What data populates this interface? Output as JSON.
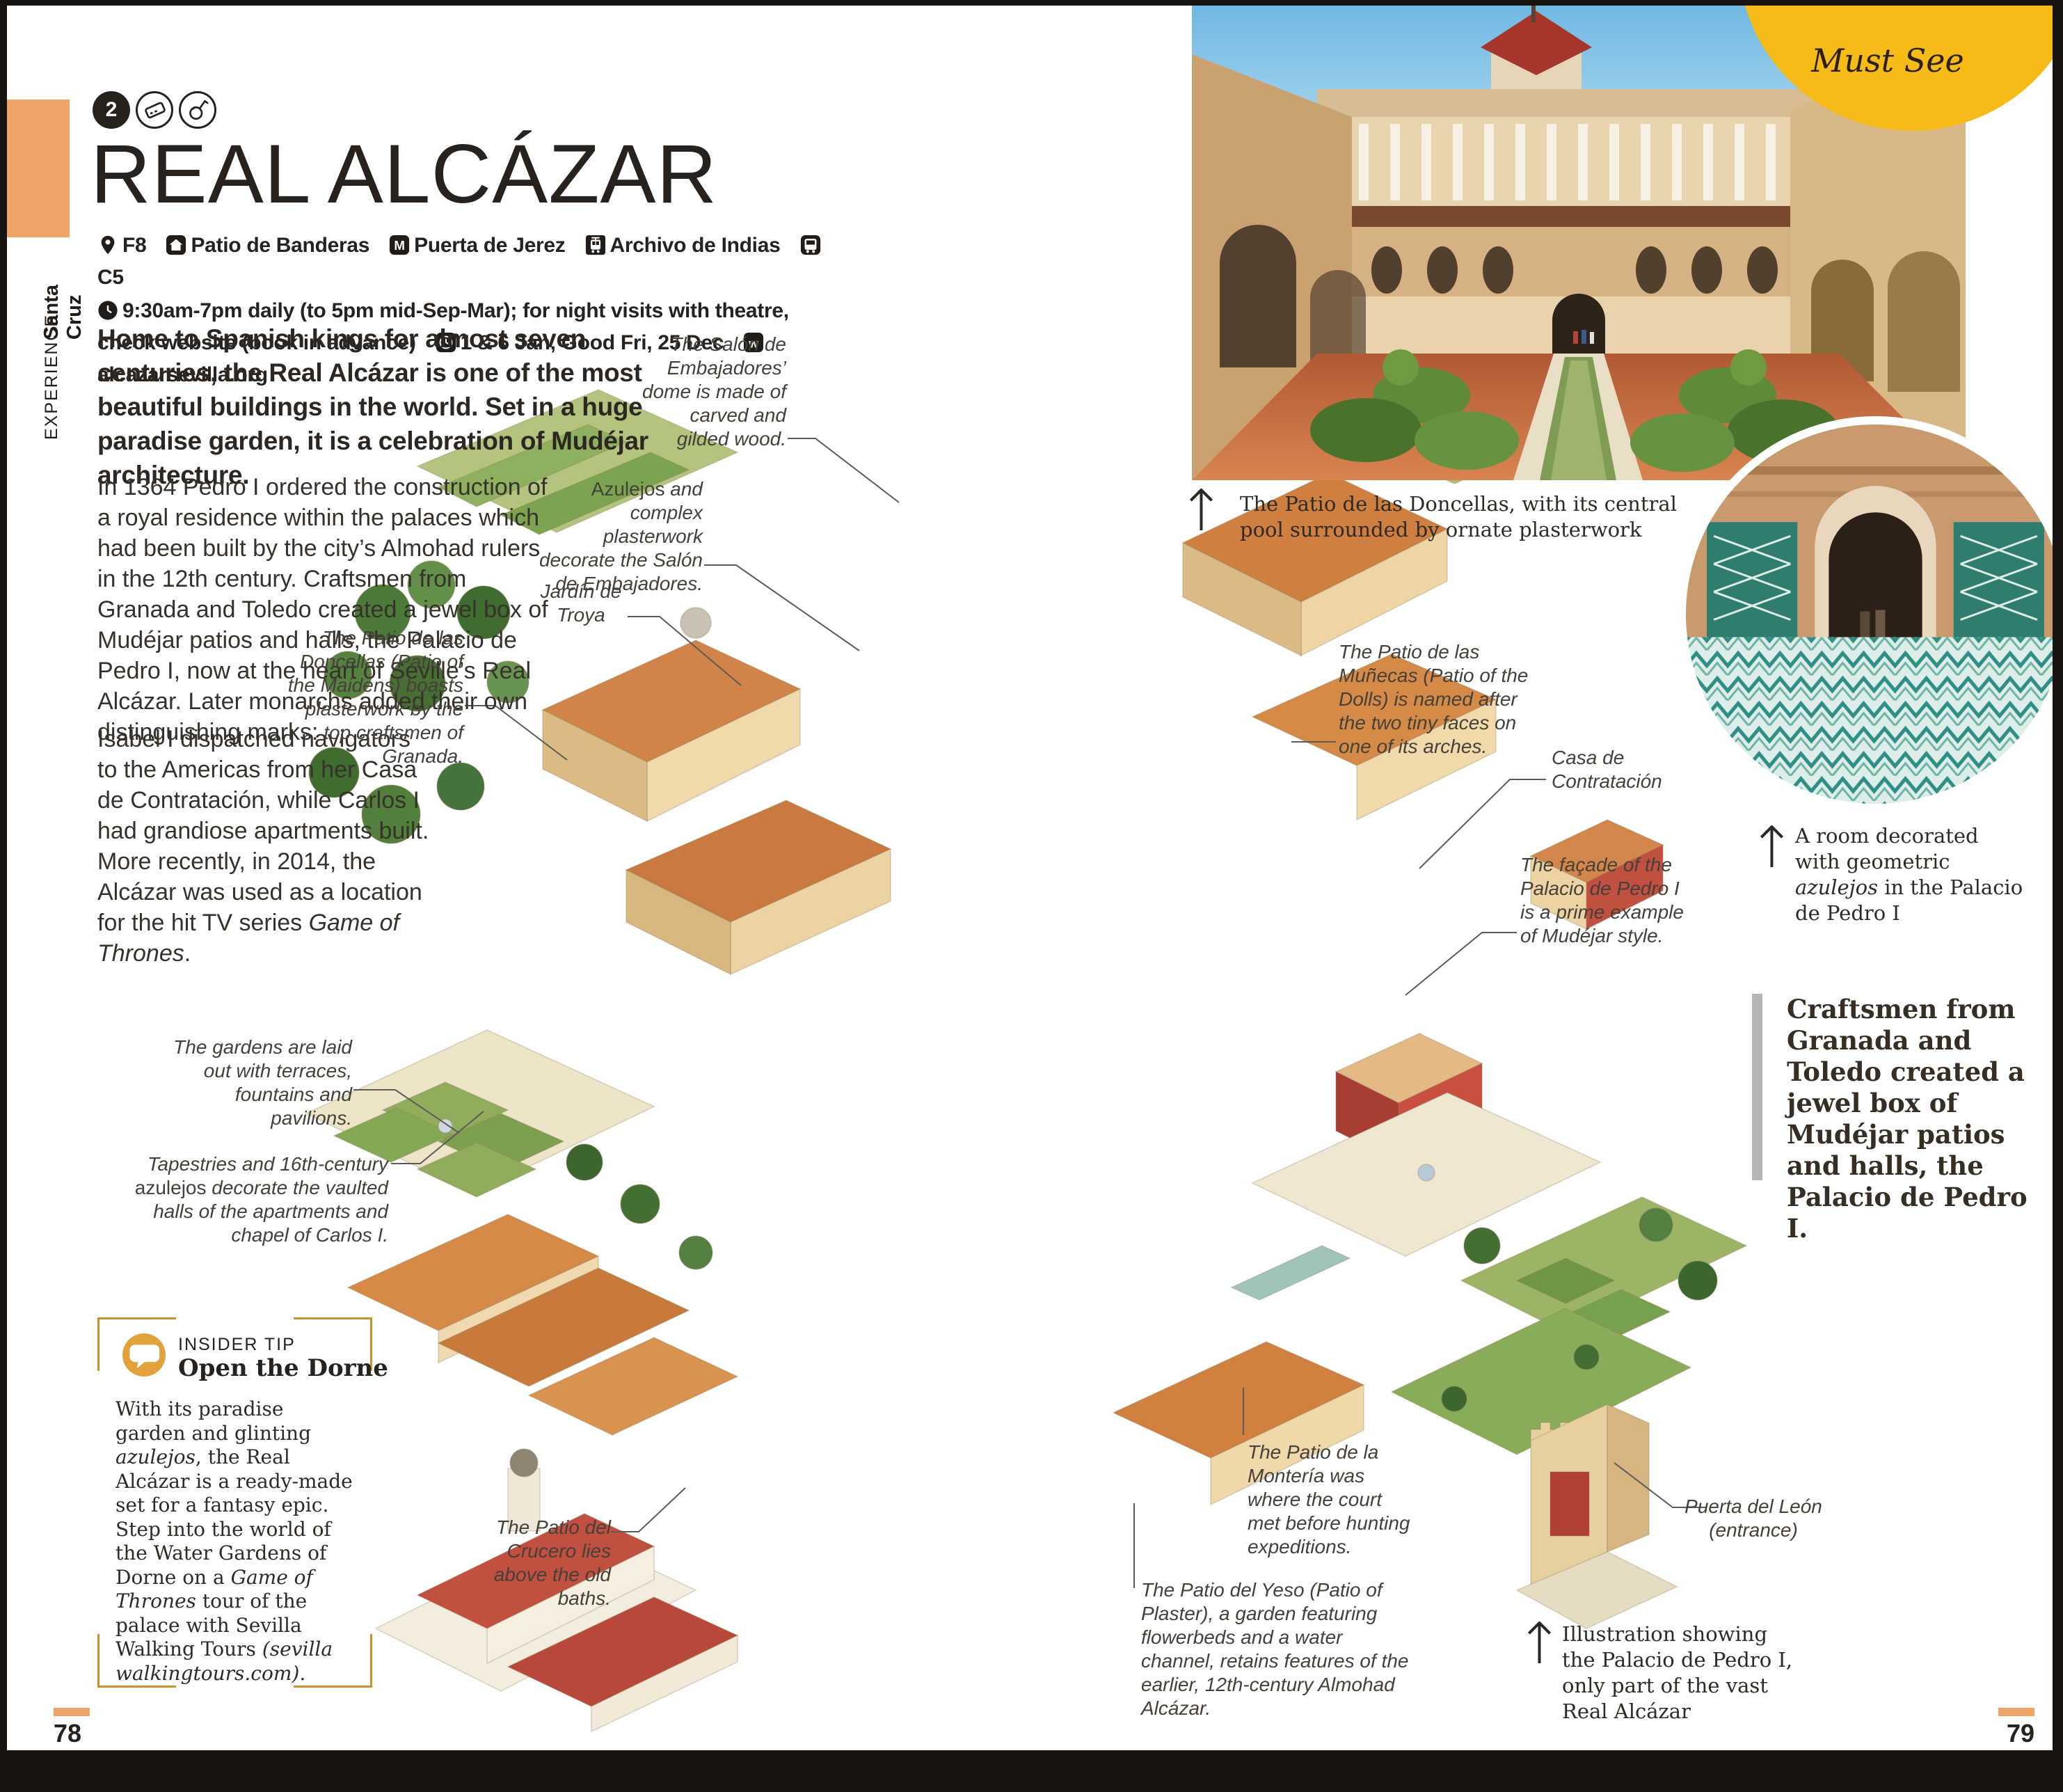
{
  "page_frame": {
    "left_page_number": "78",
    "right_page_number": "79"
  },
  "sidebar": {
    "section_label": "EXPERIENCE",
    "area_label": "Santa Cruz"
  },
  "header": {
    "map_ref_badge": "2",
    "title": "REAL ALCÁZAR",
    "location_grid": "F8",
    "nearest": "Patio de Banderas",
    "metro": "Puerta de Jerez",
    "tram": "Archivo de Indias",
    "bus": "C5",
    "hours": "9:30am-7pm daily (to 5pm mid-Sep-Mar); for night visits with theatre, check website (book in advance)",
    "closed": "1 & 6 Jan, Good Fri, 25 Dec",
    "website": "alcazarsevilla.org"
  },
  "intro": "Home to Spanish kings for almost seven centuries, the Real Alcázar is one of the most beautiful buildings in the world. Set in a huge paradise garden, it is a celebration of Mudéjar architecture.",
  "body": {
    "part1": "In 1364 Pedro I ordered the construction of a royal residence within the palaces which had been built by the city’s Almohad rulers in the 12th century. Craftsmen from Granada and Toledo created a jewel box of Mudéjar patios and halls, the Palacio de Pedro I, now at the heart of Seville’s Real Alcázar. Later monarchs added their own distinguishing marks:",
    "part2": "Isabel I dispatched navigators to the Americas from her Casa de Contratación, while Carlos I had grandiose apartments built. More recently, in 2014, the Alcázar was used as a location for the hit TV series ",
    "part2_italic": "Game of Thrones",
    "part2_end": "."
  },
  "annotations": {
    "salon_dome": "The Salón de Embajadores’ dome is made of carved and gilded wood.",
    "azulejos_1": "Azulejos",
    "azulejos_2": " and complex plasterwork decorate the Salón de Embajadores.",
    "jardin_troya": "Jardín de Troya",
    "doncellas": "The Patio de las Doncellas (Patio of the Maidens) boasts plasterwork by the top craftsmen of Granada.",
    "gardens": "The gardens are laid out with terraces, fountains and pavilions.",
    "tapestries_1": "Tapestries and 16th-century ",
    "tapestries_2": "azulejos",
    "tapestries_3": " decorate the vaulted halls of the apartments and chapel of Carlos I.",
    "crucero": "The Patio del Crucero lies above the old baths.",
    "munecas": "The Patio de las Muñecas (Patio of the Dolls) is named after the two tiny faces on one of its arches.",
    "casa_contratacion": "Casa de Contratación",
    "facade": "The façade of the Palacio de Pedro I is a prime example of Mudéjar style.",
    "monteria": "The Patio de la Montería was where the court met before hunting expeditions.",
    "yeso": "The Patio del Yeso (Patio of Plaster), a garden featuring flowerbeds and a water channel, retains features of the earlier, 12th-century Almohad Alcázar.",
    "puerta_leon_1": "Puerta del León",
    "puerta_leon_2": "(entrance)"
  },
  "photos": {
    "main_caption": "The Patio de las Doncellas, with its central pool surrounded by ornate plasterwork",
    "room_caption_1": "A room decorated with geometric ",
    "room_caption_italic": "azulejos",
    "room_caption_2": " in the Palacio de Pedro I",
    "must_see_label": "Must See"
  },
  "pull_quote": "Craftsmen from Granada and Toledo created a jewel box of Mudéjar patios and halls, the Palacio de Pedro I.",
  "insider_tip": {
    "label": "INSIDER TIP",
    "title": "Open the Dorne",
    "body_1": "With its paradise garden and glinting ",
    "italic_1": "azulejos",
    "body_2": ", the Real Alcázar is a ready-made set for a fantasy epic. Step into the world of the Water Gardens of Dorne on a ",
    "italic_2": "Game of Thrones",
    "body_3": " tour of the palace with Sevilla Walking Tours ",
    "italic_3": "(sevilla walkingtours.com)",
    "body_4": "."
  },
  "illustration_caption": "Illustration showing the Palacio de Pedro I, only part of the vast Real Alcázar",
  "colors": {
    "accent_orange": "#F1A467",
    "tip_gold": "#C9922F",
    "must_see_yellow": "#F6BB17",
    "ink": "#27221D"
  }
}
